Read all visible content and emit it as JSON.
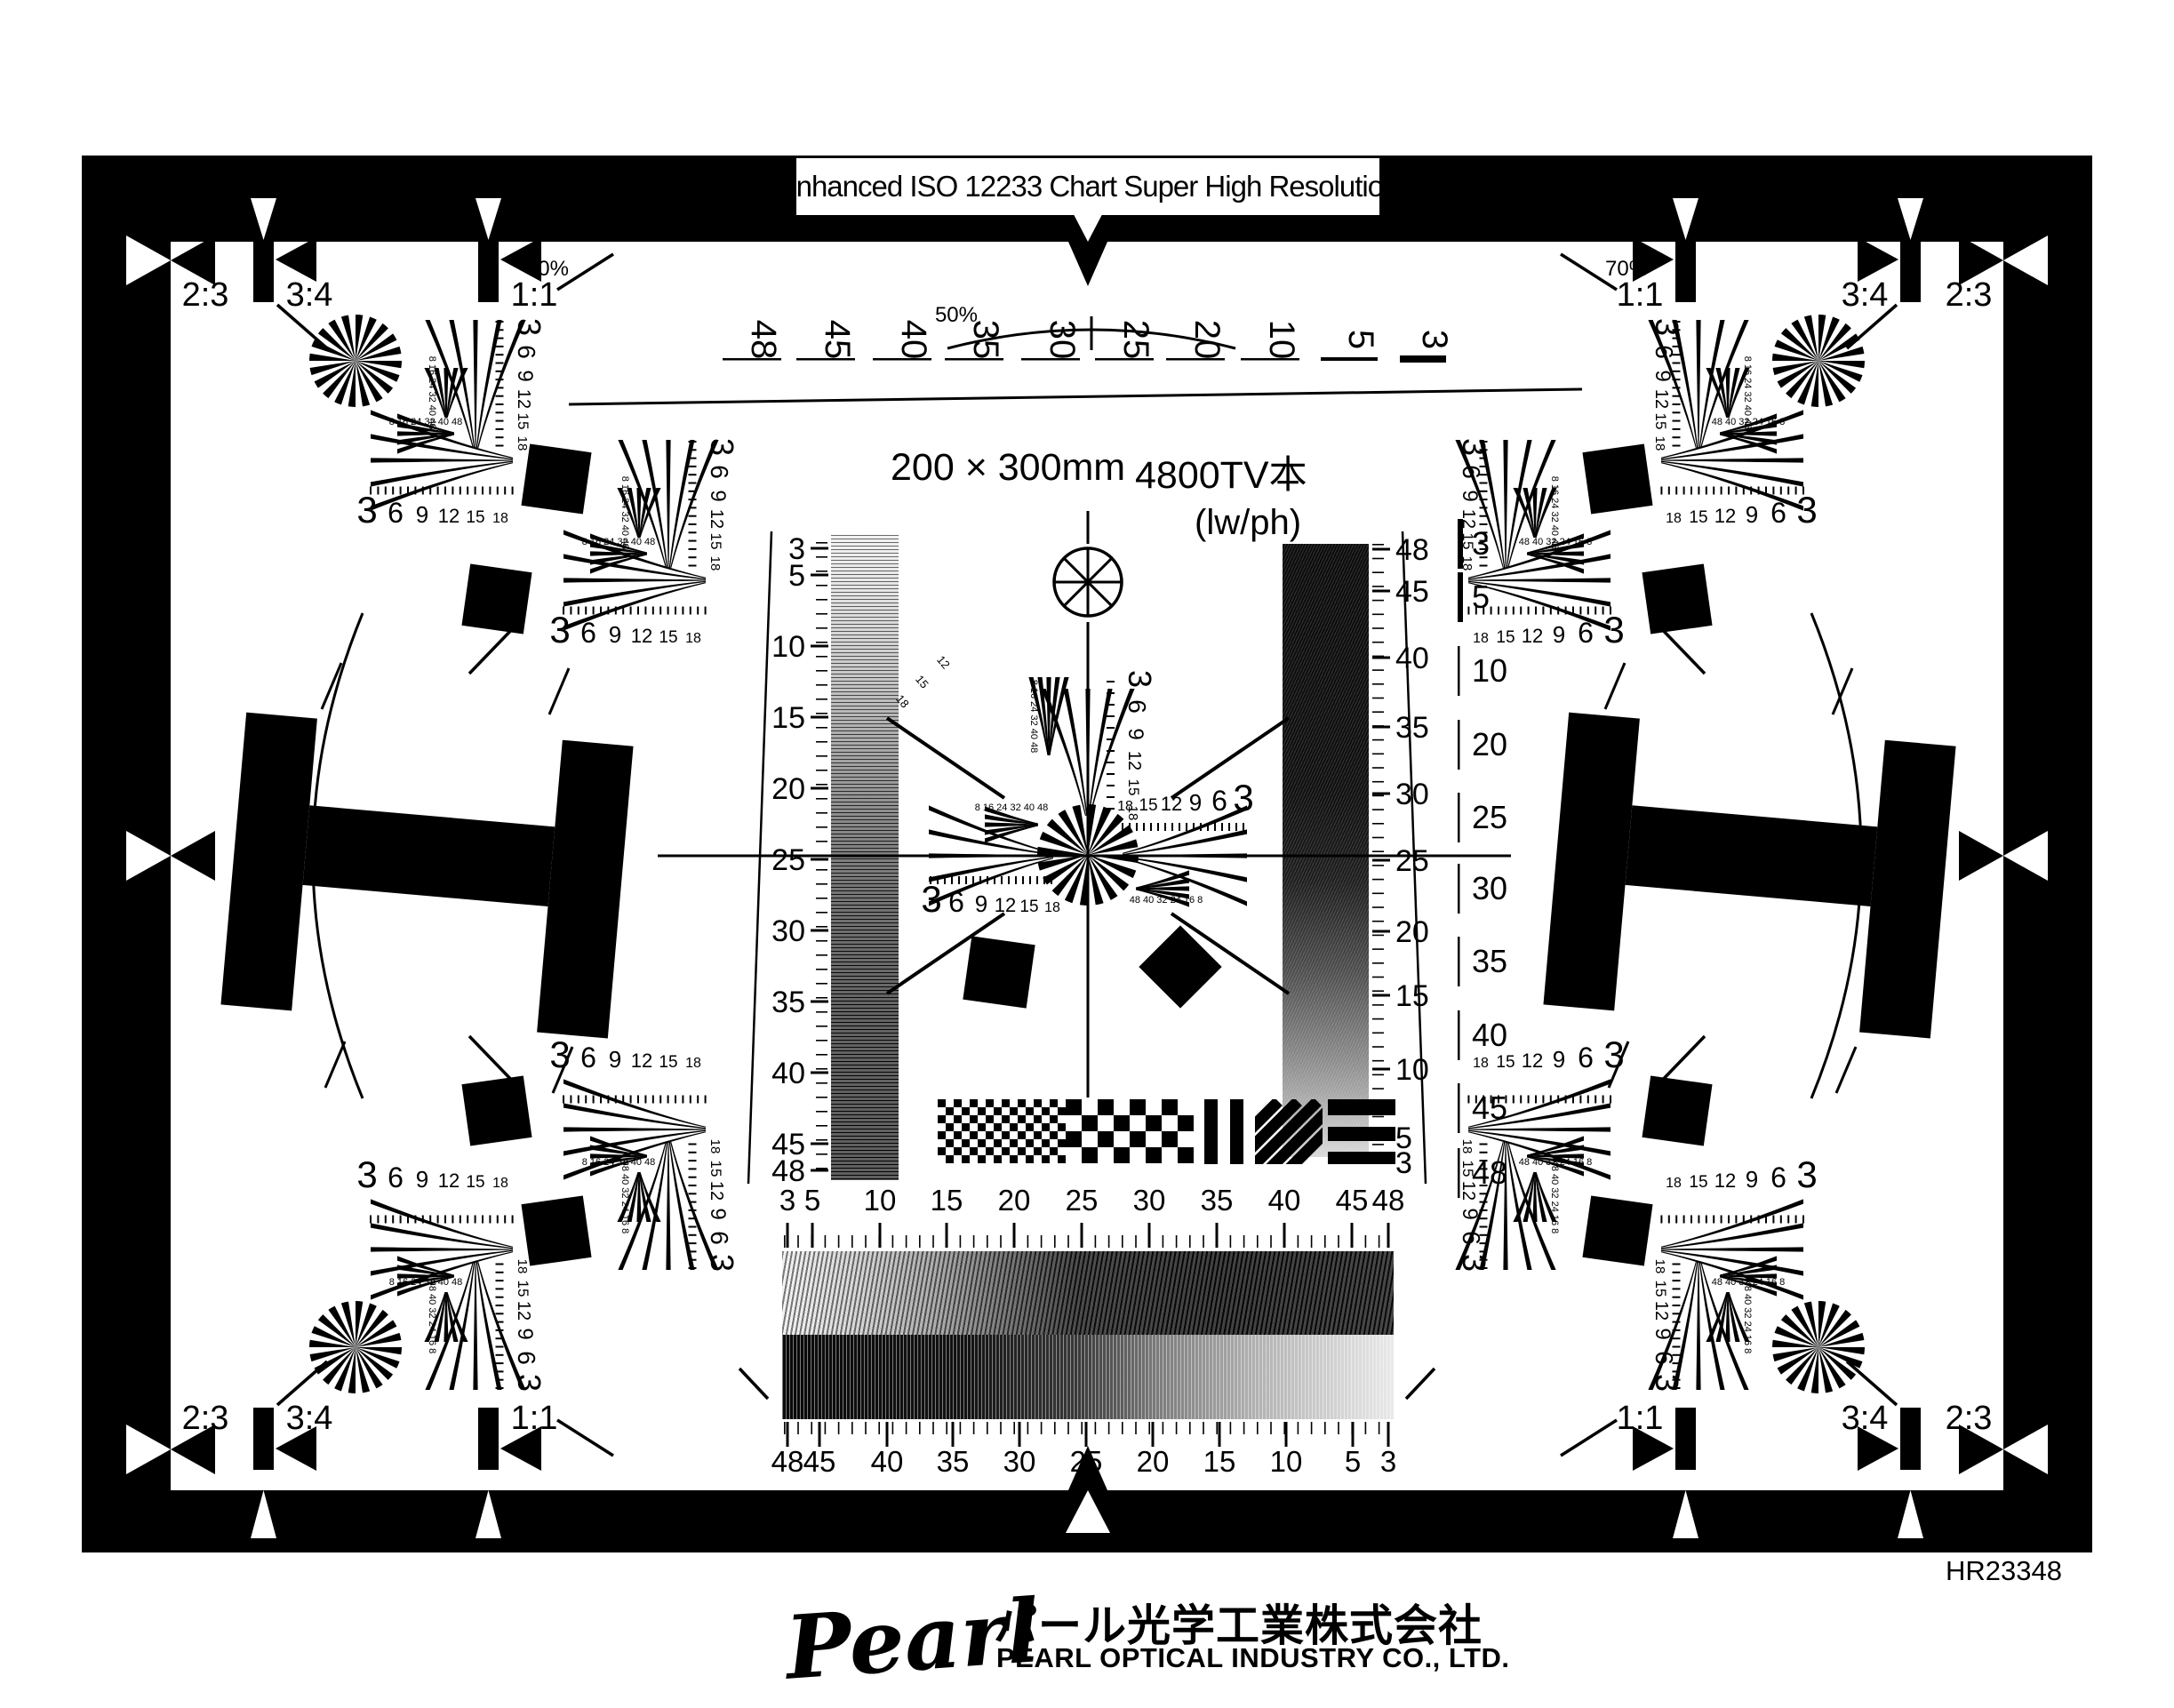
{
  "chart": {
    "title": "Enhanced ISO 12233 Chart Super High Resolution",
    "serial": "HR23348",
    "center_labels": {
      "size": "200 × 300mm",
      "tv_lines": "4800TV本",
      "unit": "(lw/ph)"
    },
    "percent_labels": {
      "half": "50%",
      "seventy": "70%"
    },
    "aspect_ratios": [
      "2:3",
      "3:4",
      "1:1"
    ],
    "footer": {
      "logo": "Pearl",
      "company_jp": "パール光学工業株式会社",
      "company_en": "PEARL OPTICAL INDUSTRY CO., LTD."
    }
  },
  "scales": {
    "top_lwph": {
      "values": [
        "48",
        "45",
        "40",
        "35",
        "30",
        "25",
        "20",
        "10",
        "5",
        "3"
      ]
    },
    "left_sweep": {
      "values": [
        "3",
        "5",
        "10",
        "15",
        "20",
        "25",
        "30",
        "35",
        "40",
        "45",
        "48"
      ]
    },
    "right_sweep_inner": {
      "values": [
        "48",
        "45",
        "40",
        "35",
        "30",
        "25",
        "20",
        "15",
        "10",
        "5",
        "3"
      ]
    },
    "right_sweep_outer": {
      "values": [
        "3",
        "5",
        "10",
        "20",
        "25",
        "30",
        "35",
        "40",
        "45",
        "48"
      ]
    },
    "bottom_sweep_top": {
      "values": [
        "3",
        "5",
        "10",
        "15",
        "20",
        "25",
        "30",
        "35",
        "40",
        "45",
        "48"
      ]
    },
    "bottom_sweep_bottom": {
      "values": [
        "48",
        "45",
        "40",
        "35",
        "30",
        "25",
        "20",
        "15",
        "10",
        "5",
        "3"
      ]
    },
    "wedge": {
      "values": [
        "3",
        "6",
        "9",
        "12",
        "15",
        "18"
      ]
    },
    "wedge_fine": {
      "values": [
        "8",
        "16",
        "24",
        "32",
        "40",
        "48"
      ]
    }
  },
  "colors": {
    "ink": "#000000",
    "paper": "#ffffff"
  }
}
